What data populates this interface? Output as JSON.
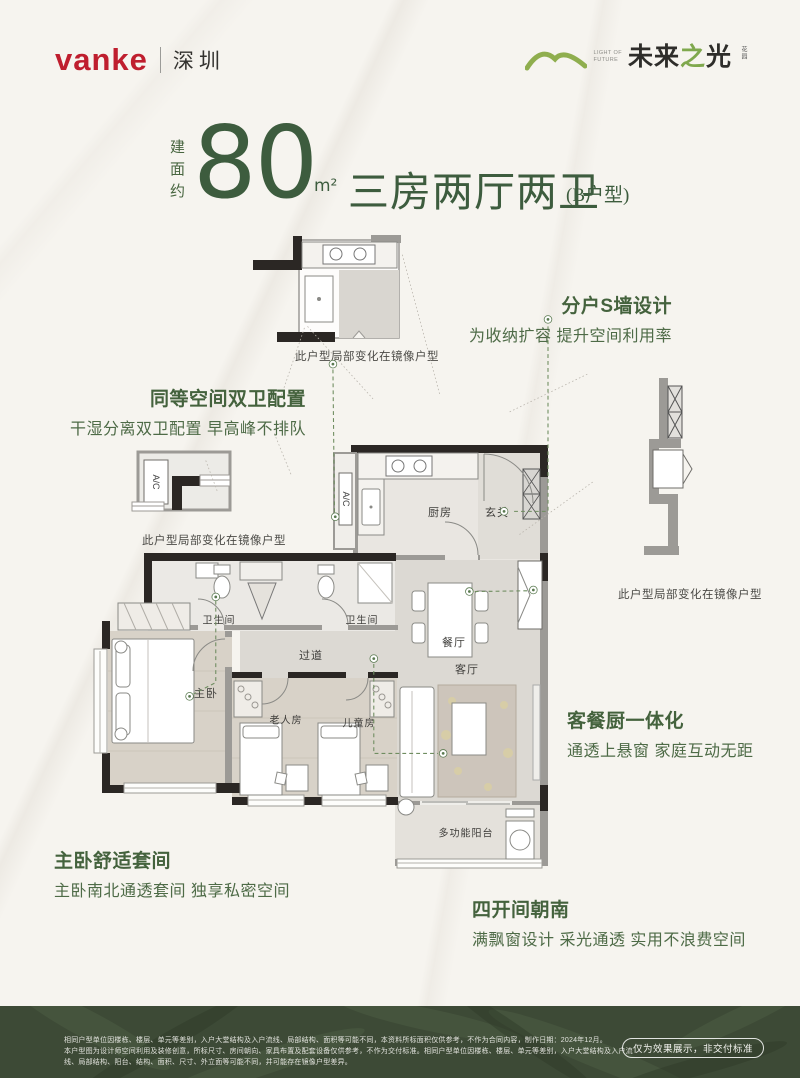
{
  "header": {
    "brand": "vanke",
    "city": "深圳",
    "project": {
      "tagline_line1": "LIGHT OF",
      "tagline_line2": "FUTURE",
      "name_pre": "未来",
      "name_mid": "之",
      "name_post": "光",
      "name_suffix": "花园"
    }
  },
  "title": {
    "prefix": "建面约",
    "area": "80",
    "unit": "m²",
    "layout": "三房两厅两卫",
    "type_tag": "(B户型)"
  },
  "floorplan": {
    "labels": {
      "kitchen": "厨房",
      "foyer": "玄关",
      "dining": "餐厅",
      "living": "客厅",
      "corridor": "过道",
      "master": "主卧",
      "elder": "老人房",
      "child": "儿童房",
      "bath": "卫生间",
      "balcony": "多功能阳台",
      "ac": "A/C"
    },
    "mirror_note": "此户型局部变化在镜像户型"
  },
  "annotations": [
    {
      "title": "分户S墙设计",
      "desc": "为收纳扩容 提升空间利用率"
    },
    {
      "title": "同等空间双卫配置",
      "desc": "干湿分离双卫配置 早高峰不排队"
    },
    {
      "title": "客餐厨一体化",
      "desc": "通透上悬窗 家庭互动无距"
    },
    {
      "title": "主卧舒适套间",
      "desc": "主卧南北通透套间 独享私密空间"
    },
    {
      "title": "四开间朝南",
      "desc": "满飘窗设计 采光通透 实用不浪费空间"
    }
  ],
  "footer": {
    "disclaimer_line1": "相同户型单位因楼栋、楼层、单元等差别，入户大堂结构及入户流线、局部结构、面积等可能不同，本资料所标面积仅供参考，不作为合同内容，制作日期：2024年12月。",
    "disclaimer_line2": "本户型图为设计师空间利用及装修创意，所标尺寸、房间朝向、家具布置及配套设备仅供参考，不作为交付标准。相同户型单位因楼栋、楼层、单元等差别，入户大堂结构及入户流线、局部结构、阳台、结构、面积、尺寸、外立面等可能不同，并可能存在镜像户型差异。",
    "badge": "仅为效果展示，非交付标准"
  },
  "colors": {
    "brand_red": "#bf1e2e",
    "logo_green": "#8fae4e",
    "title_green": "#3d5c3e",
    "annotation_green": "#4e6b47",
    "footer_bg": "#3d4a36"
  }
}
